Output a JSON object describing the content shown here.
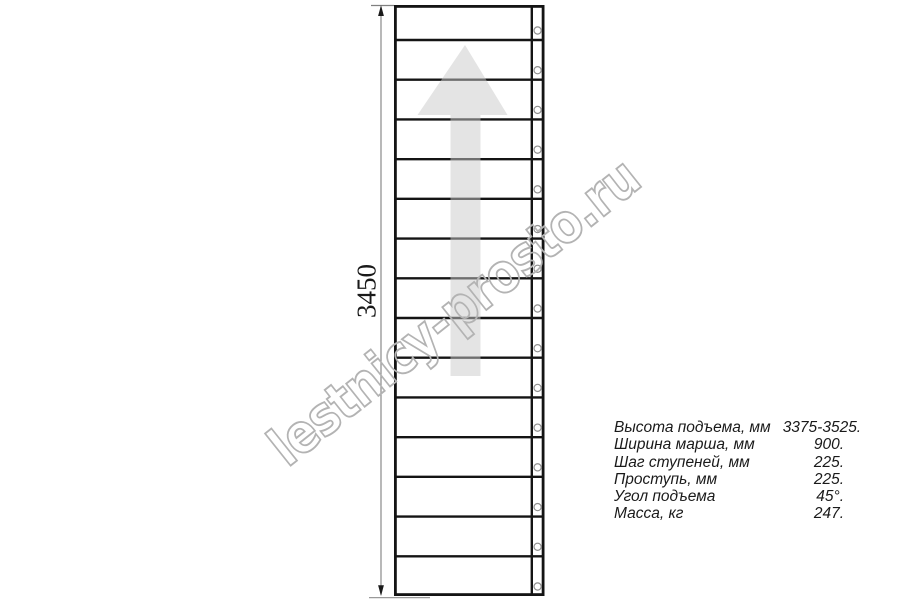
{
  "diagram": {
    "type": "staircase-plan-top-view",
    "dimension_label": "3450",
    "watermark": "lestnicy-prosto.ru",
    "direction_arrow": "up",
    "staircase": {
      "step_count": 15
    }
  },
  "specs": {
    "rows": [
      {
        "label": "Высота подъема, мм",
        "value": "3375-3525."
      },
      {
        "label": "Ширина марша, мм",
        "value": "900."
      },
      {
        "label": "Шаг ступеней, мм",
        "value": "225."
      },
      {
        "label": "Проступь, мм",
        "value": "225."
      },
      {
        "label": "Угол подъема",
        "value": "45°."
      },
      {
        "label": "Масса, кг",
        "value": "247."
      }
    ]
  },
  "colors": {
    "drawing_line": "#141414",
    "dimension_line": "#8a8a8a",
    "arrow_fill": "#c9c9c9",
    "watermark_outline": "#b3b3b3",
    "text": "#1a1a1a",
    "background": "#ffffff"
  }
}
